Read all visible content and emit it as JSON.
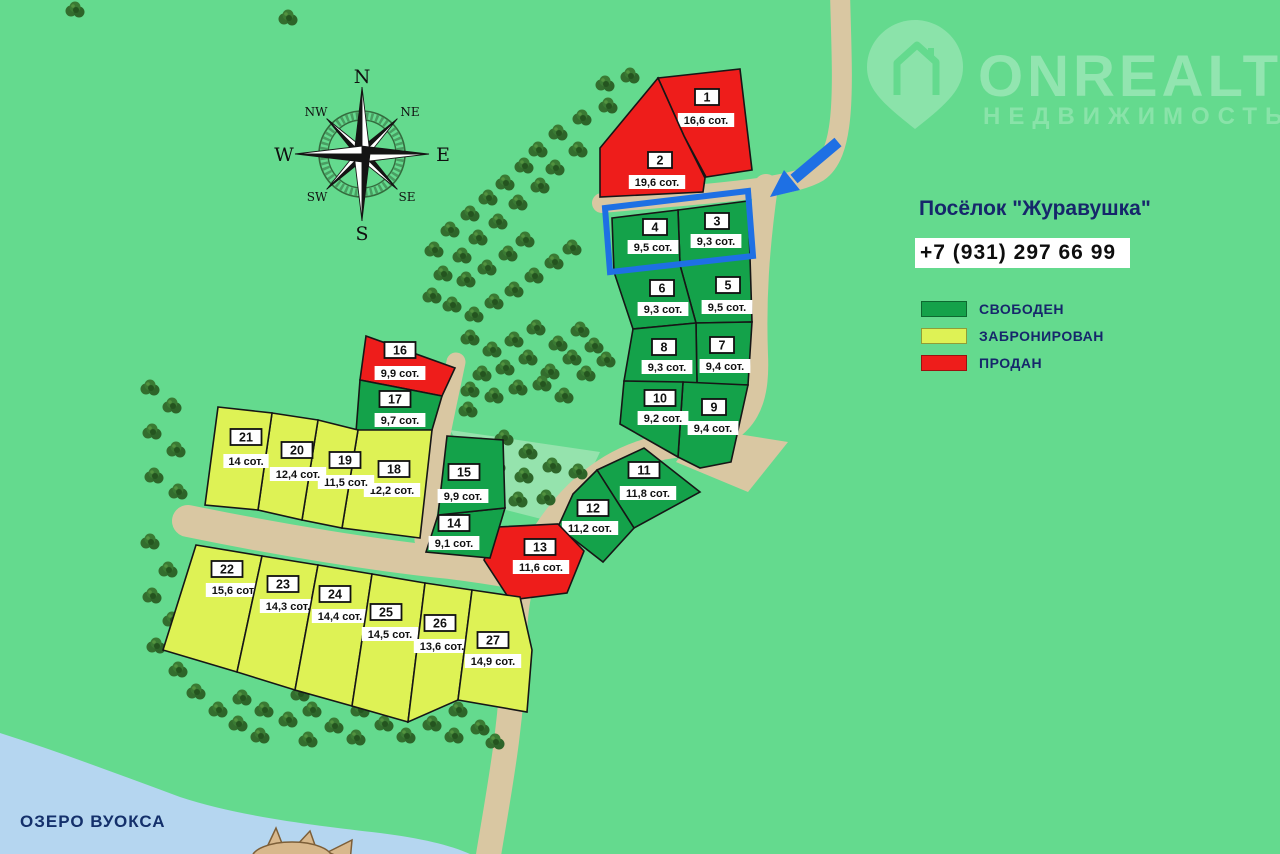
{
  "map": {
    "title": "Посёлок \"Журавушка\"",
    "phone": "+7 (931) 297 66 99",
    "lake_label": "ОЗЕРО ВУОКСА",
    "watermark": {
      "brand": "ONREALT",
      "subtitle": "НЕДВИЖИМОСТЬ"
    },
    "colors": {
      "background": "#64da8e",
      "road": "#d9c7a2",
      "lake": "#b5d6f0",
      "free": "#14a24a",
      "booked": "#def255",
      "sold": "#ee1d1b",
      "accent_blue": "#1e70e4",
      "text_navy": "#16276b"
    },
    "legend": [
      {
        "status": "free",
        "label": "СВОБОДЕН",
        "color": "#14a24a"
      },
      {
        "status": "booked",
        "label": "ЗАБРОНИРОВАН",
        "color": "#def255"
      },
      {
        "status": "sold",
        "label": "ПРОДАН",
        "color": "#ee1d1b"
      }
    ],
    "compass": {
      "n": "N",
      "ne": "NE",
      "e": "E",
      "se": "SE",
      "s": "S",
      "sw": "SW",
      "w": "W",
      "nw": "NW"
    },
    "highlighted_plots": [
      "3",
      "4"
    ],
    "plots": [
      {
        "number": "1",
        "area_label": "16,6 сот.",
        "status": "sold"
      },
      {
        "number": "2",
        "area_label": "19,6 сот.",
        "status": "sold"
      },
      {
        "number": "3",
        "area_label": "9,3 сот.",
        "status": "free"
      },
      {
        "number": "4",
        "area_label": "9,5 сот.",
        "status": "free"
      },
      {
        "number": "5",
        "area_label": "9,5 сот.",
        "status": "free"
      },
      {
        "number": "6",
        "area_label": "9,3 сот.",
        "status": "free"
      },
      {
        "number": "7",
        "area_label": "9,4 сот.",
        "status": "free"
      },
      {
        "number": "8",
        "area_label": "9,3 сот.",
        "status": "free"
      },
      {
        "number": "9",
        "area_label": "9,4 сот.",
        "status": "free"
      },
      {
        "number": "10",
        "area_label": "9,2 сот.",
        "status": "free"
      },
      {
        "number": "11",
        "area_label": "11,8 сот.",
        "status": "free"
      },
      {
        "number": "12",
        "area_label": "11,2 сот.",
        "status": "free"
      },
      {
        "number": "13",
        "area_label": "11,6 сот.",
        "status": "sold"
      },
      {
        "number": "14",
        "area_label": "9,1 сот.",
        "status": "free"
      },
      {
        "number": "15",
        "area_label": "9,9 сот.",
        "status": "free"
      },
      {
        "number": "16",
        "area_label": "9,9 сот.",
        "status": "sold"
      },
      {
        "number": "17",
        "area_label": "9,7 сот.",
        "status": "free"
      },
      {
        "number": "18",
        "area_label": "12,2 сот.",
        "status": "booked"
      },
      {
        "number": "19",
        "area_label": "11,5 сот.",
        "status": "booked"
      },
      {
        "number": "20",
        "area_label": "12,4 сот.",
        "status": "booked"
      },
      {
        "number": "21",
        "area_label": "14 сот.",
        "status": "booked"
      },
      {
        "number": "22",
        "area_label": "15,6 сот.",
        "status": "booked"
      },
      {
        "number": "23",
        "area_label": "14,3 сот.",
        "status": "booked"
      },
      {
        "number": "24",
        "area_label": "14,4 сот.",
        "status": "booked"
      },
      {
        "number": "25",
        "area_label": "14,5 сот.",
        "status": "booked"
      },
      {
        "number": "26",
        "area_label": "13,6 сот.",
        "status": "booked"
      },
      {
        "number": "27",
        "area_label": "14,9 сот.",
        "status": "booked"
      }
    ]
  }
}
